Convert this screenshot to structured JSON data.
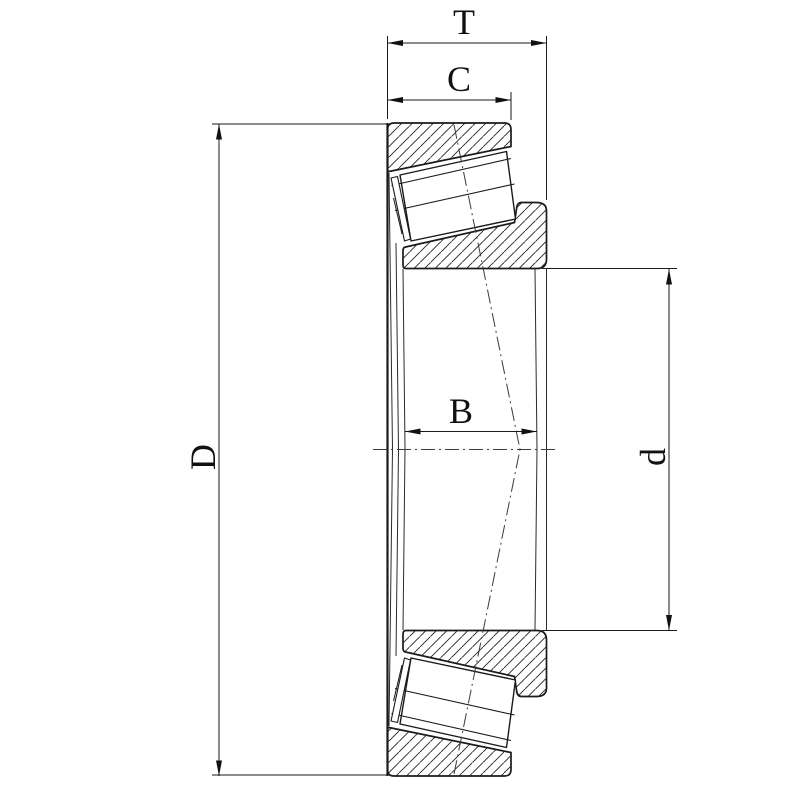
{
  "page": {
    "background": "#ffffff"
  },
  "drawing": {
    "line_color": "#1a1a1a",
    "centerline_color": "#3a3a3a",
    "labels": {
      "total_width": "T",
      "cup_width": "C",
      "cone_width": "B",
      "outer_diameter": "D",
      "bore_diameter": "d"
    }
  }
}
